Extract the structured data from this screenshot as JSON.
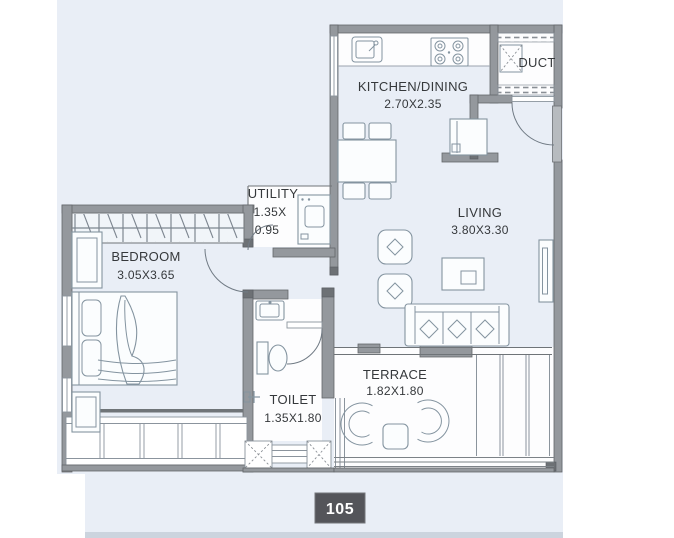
{
  "plan": {
    "unit_number": "105",
    "rooms": {
      "kitchen_dining": {
        "name": "KITCHEN/DINING",
        "dims": "2.70X2.35"
      },
      "duct": {
        "name": "DUCT"
      },
      "living": {
        "name": "LIVING",
        "dims": "3.80X3.30"
      },
      "utility": {
        "name": "UTILITY",
        "dims_line1": "1.35X",
        "dims_line2": "0.95"
      },
      "bedroom": {
        "name": "BEDROOM",
        "dims": "3.05X3.65"
      },
      "toilet": {
        "name": "TOILET",
        "dims": "1.35X1.80"
      },
      "terrace": {
        "name": "TERRACE",
        "dims": "1.82X1.80"
      }
    },
    "colors": {
      "canvas": "#e9eef6",
      "wall": "#94989d",
      "wall_dark": "#6d7175",
      "furniture_line": "#8494a0",
      "text": "#35383b",
      "badge_bg": "#54555a",
      "badge_text": "#ffffff"
    }
  }
}
